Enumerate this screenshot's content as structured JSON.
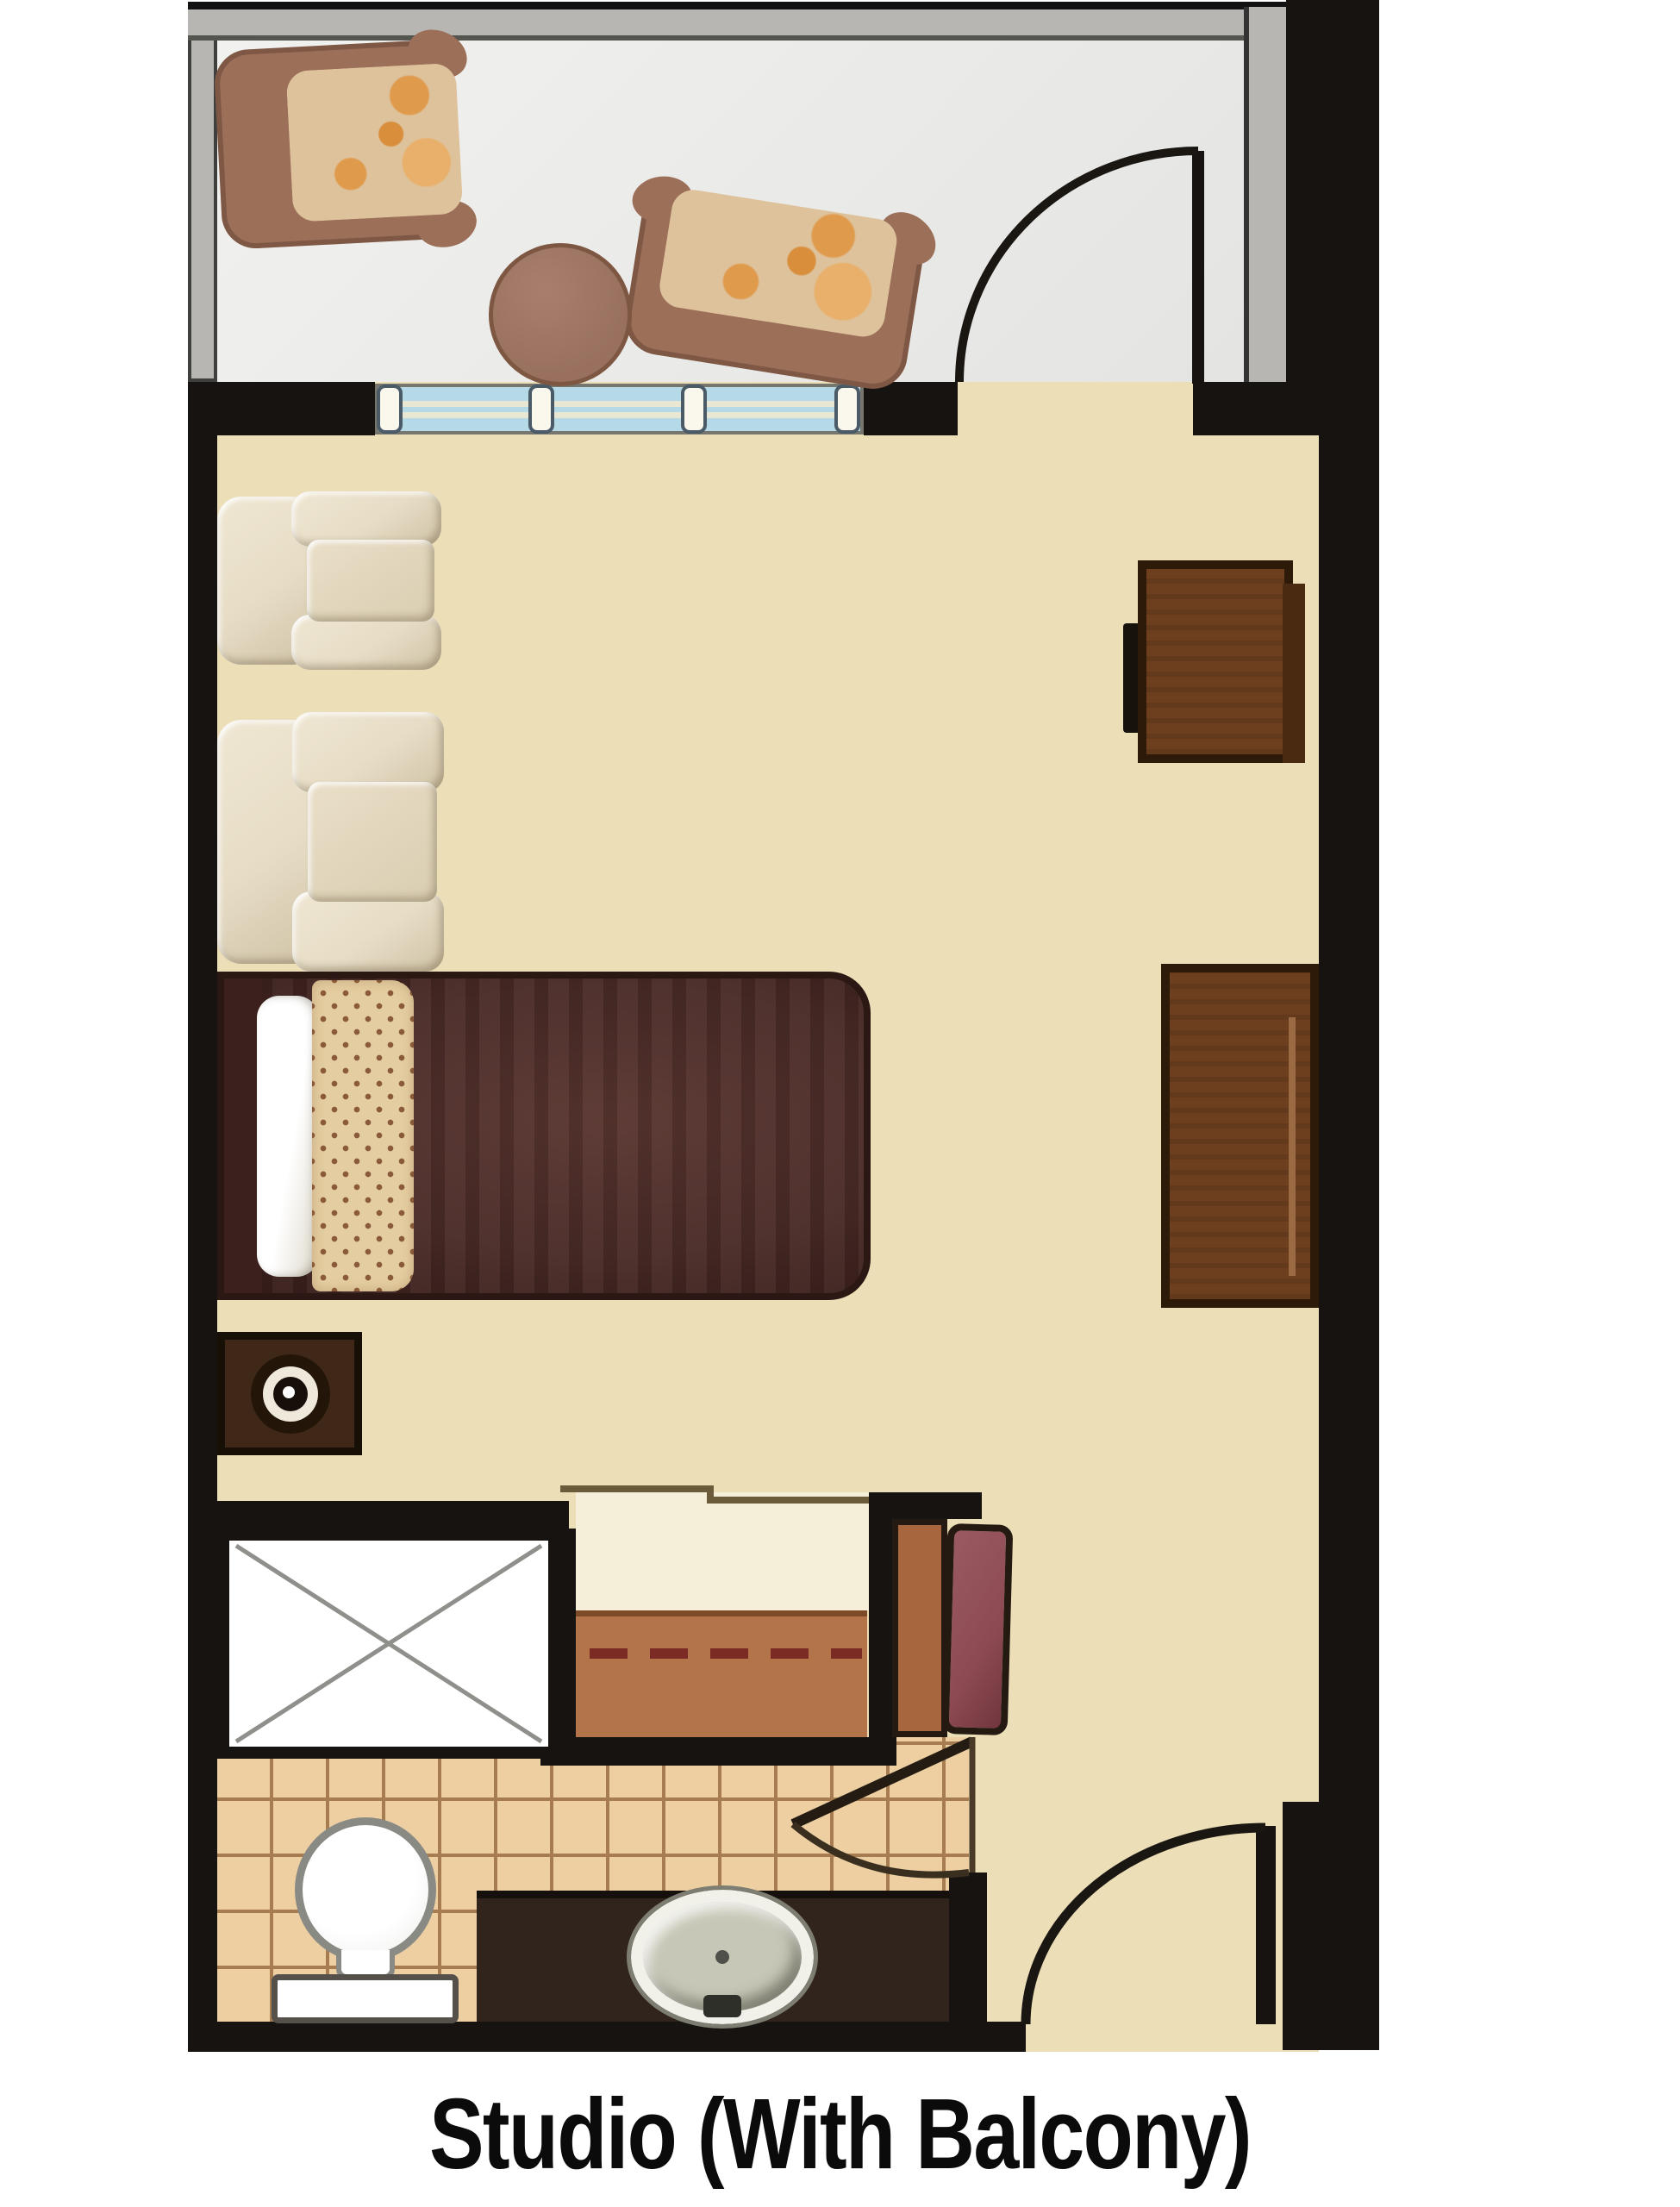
{
  "title": {
    "label": "Studio (With Balcony)"
  },
  "palette": {
    "wall": "#171310",
    "balconyWallGray": "#b7b6b2",
    "balconyFloor": "#ebebe9",
    "floorTan": "#ecdeb6",
    "closetFloor": "#f5eed9",
    "closetMat": "#b3744a",
    "rodRed": "#7c2b24",
    "tileBg": "#edcfa2",
    "tileLine": "#a67c50",
    "glassBlue": "#b5d9e6",
    "mullion": "#faf7ec",
    "chairCream": "#e7ddc6",
    "chairCreamShade": "#cfc2a6",
    "patioBrown": "#9c6f59",
    "patioCushion": "#dec29c",
    "patioOrange": "#df9a4c",
    "tableBrown": "#99705e",
    "woodDark": "#6e3f1f",
    "woodBorder": "#2e1a08",
    "bedMaroon": "#4a2b27",
    "bedDark": "#361d1a",
    "pillowTrim": "#e4cda0",
    "trimDot": "#8b5a3a",
    "counterDark": "#31241c",
    "benchMaroon": "#8d4a52",
    "benchBaseBrown": "#a8663f"
  },
  "plan": {
    "rooms": [
      {
        "name": "balcony",
        "furniture": [
          "patio armchair",
          "patio armchair",
          "round table"
        ],
        "features": [
          "glass railing wall",
          "window with four mullions",
          "swing door to balcony"
        ]
      },
      {
        "name": "studio room",
        "furniture": [
          "armchair",
          "armchair",
          "desk with chair",
          "dresser",
          "bed with pillow",
          "nightstand with lamp",
          "bench with cushion"
        ]
      },
      {
        "name": "closet",
        "features": [
          "dashed hanging rod",
          "floor mat"
        ]
      },
      {
        "name": "bathroom",
        "fixtures": [
          "corner shower with X symbol",
          "toilet",
          "vanity counter with oval sink"
        ],
        "floor": "square tile"
      }
    ],
    "doors": [
      "balcony swing door",
      "bathroom swing door",
      "entry swing door"
    ]
  }
}
